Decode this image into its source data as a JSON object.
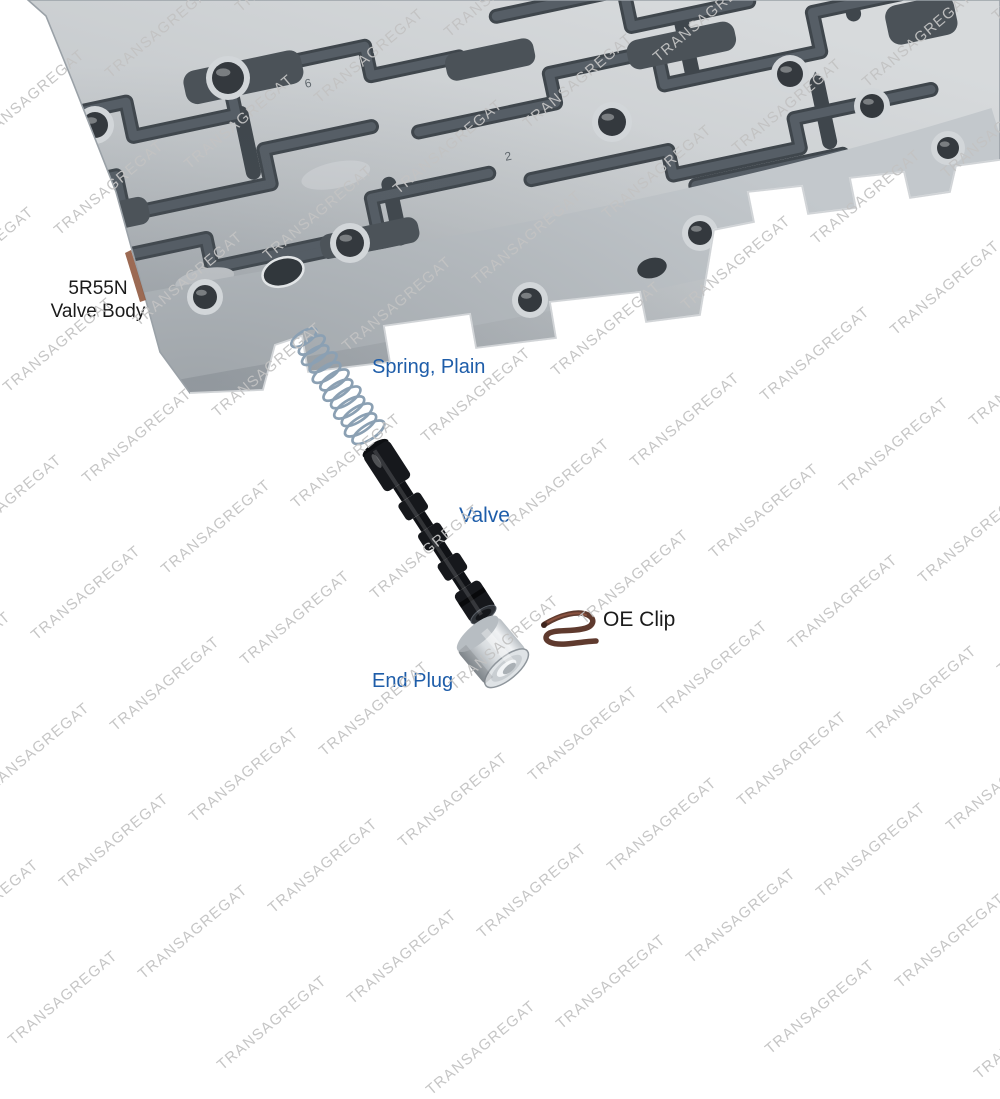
{
  "watermark": {
    "text": "TRANSAGREGAT",
    "color": "#c3c3c3"
  },
  "callouts": {
    "valve_body": {
      "line1": "5R55N",
      "line2": "Valve Body",
      "color": "#1b1b1b"
    },
    "spring": {
      "label": "Spring, Plain",
      "color": "#1e5da9"
    },
    "valve": {
      "label": "Valve",
      "color": "#1e5da9"
    },
    "oe_clip": {
      "label": "OE Clip",
      "color": "#1b1b1b"
    },
    "end_plug": {
      "label": "End Plug",
      "color": "#1e5da9"
    }
  },
  "stamped_marks": [
    {
      "text": "6"
    },
    {
      "text": "2"
    },
    {
      "text": "4"
    }
  ],
  "palette": {
    "background": "#ffffff",
    "body_light": "#d7dadc",
    "body_mid": "#c0c5c9",
    "body_dark": "#a7adb3",
    "channel_dark": "#454c52",
    "spring_steel": "#8ba0b3",
    "valve_black": "#16181c",
    "plug_silver": "#c6cbcf",
    "clip_brown": "#5f3a2e",
    "gasket_edge": "#915a40"
  }
}
